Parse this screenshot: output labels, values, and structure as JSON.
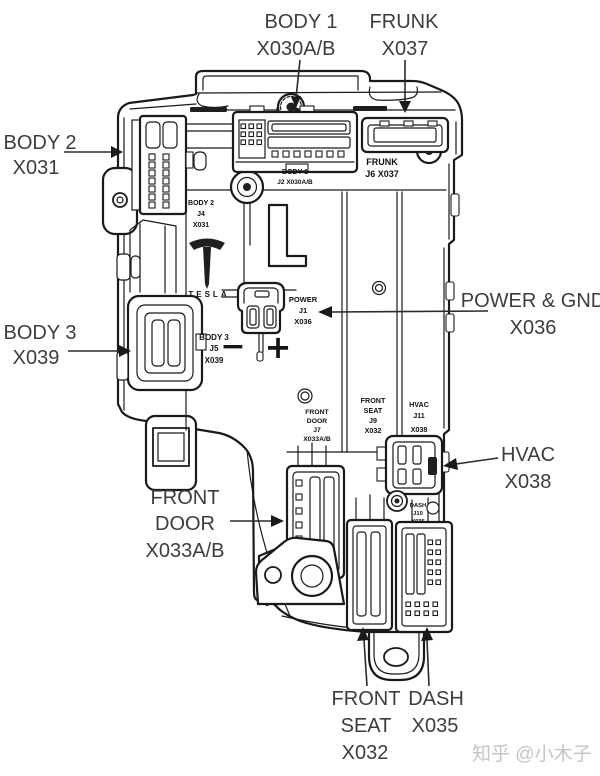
{
  "callouts": {
    "body1": {
      "name": "BODY 1",
      "code": "X030A/B"
    },
    "frunk": {
      "name": "FRUNK",
      "code": "X037"
    },
    "body2": {
      "name": "BODY 2",
      "code": "X031"
    },
    "body3": {
      "name": "BODY 3",
      "code": "X039"
    },
    "power_gnd": {
      "name": "POWER & GND",
      "code": "X036"
    },
    "hvac": {
      "name": "HVAC",
      "code": "X038"
    },
    "front_door": {
      "name": "FRONT",
      "name2": "DOOR",
      "code": "X033A/B"
    },
    "front_seat": {
      "name": "FRONT",
      "name2": "SEAT",
      "code": "X032"
    },
    "dash": {
      "name": "DASH",
      "code": "X035"
    }
  },
  "internal": {
    "body2": {
      "l1": "BODY 2",
      "l2": "J4",
      "l3": "X031"
    },
    "body1": {
      "l1": "BODY 1",
      "l2": "J2 X030A/B"
    },
    "frunk": {
      "l1": "FRUNK",
      "l2": "J6 X037"
    },
    "body3": {
      "l1": "BODY 3",
      "l2": "J5",
      "l3": "X039"
    },
    "power": {
      "l1": "POWER",
      "l2": "J1",
      "l3": "X036"
    },
    "front_door": {
      "l1": "FRONT",
      "l2": "DOOR",
      "l3": "J7",
      "l4": "X033A/B"
    },
    "front_seat": {
      "l1": "FRONT",
      "l2": "SEAT",
      "l3": "J9",
      "l4": "X032"
    },
    "hvac": {
      "l1": "HVAC",
      "l2": "J11",
      "l3": "X038"
    },
    "dash": {
      "l1": "DASH",
      "l2": "J10",
      "l3": "X035"
    }
  },
  "brand": {
    "wordmark": "TESLA",
    "molded_letter": "L"
  },
  "power_symbols": {
    "minus": "−",
    "plus": "+"
  },
  "watermark": "知乎 @小木子",
  "colors": {
    "line": "#1a1a1a",
    "callout_text": "#3d3d3d",
    "internal_text": "#101010",
    "watermark": "#c5c5c5",
    "background": "#ffffff"
  }
}
